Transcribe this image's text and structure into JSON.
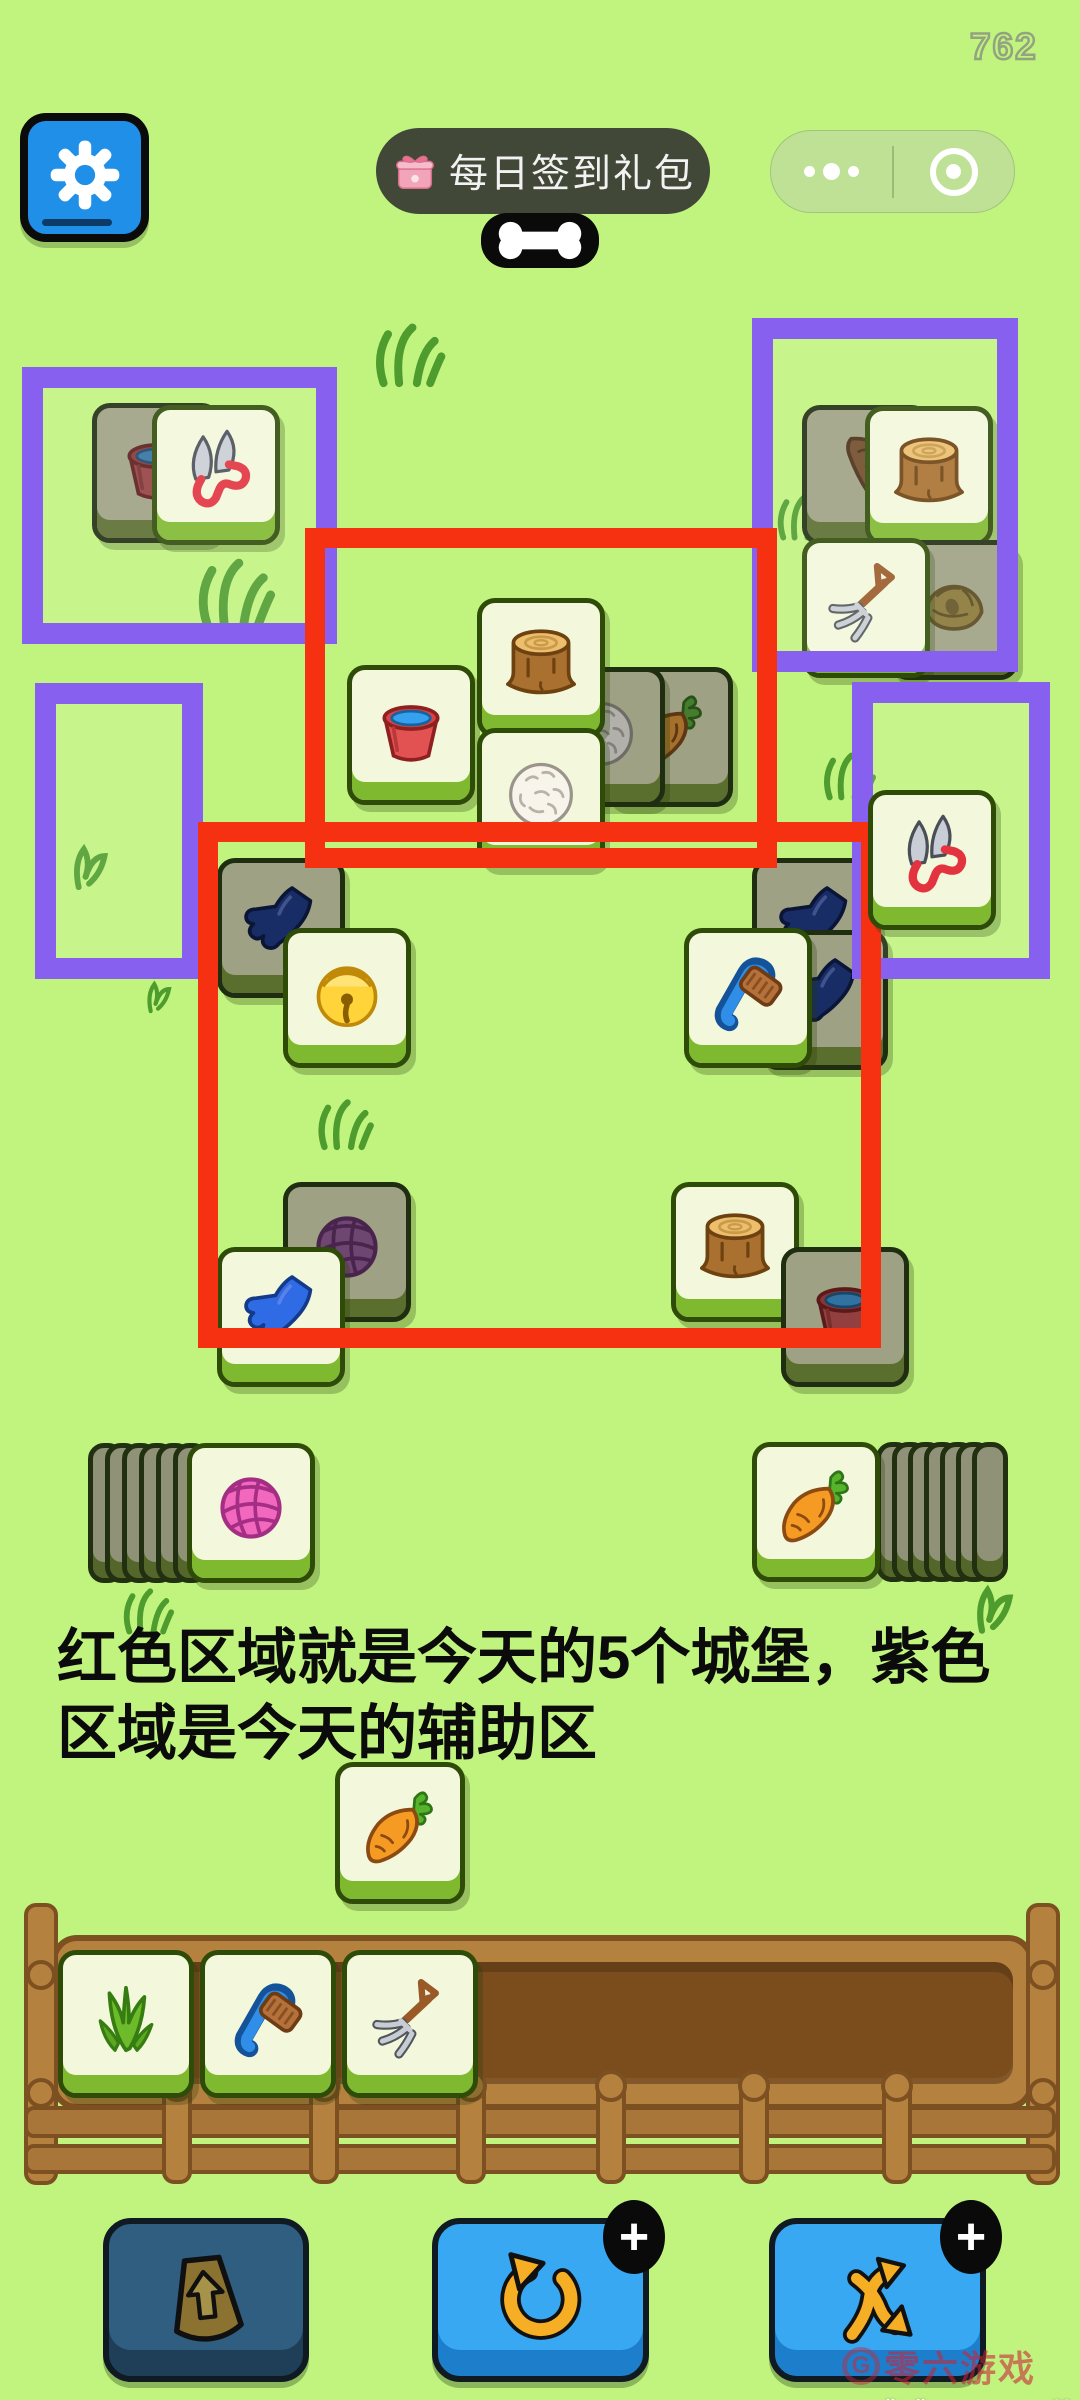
{
  "colors": {
    "background": "#C1F47F",
    "annotation_red": "#F53111",
    "annotation_purple": "#8760EF",
    "tile_front_bg": "#F3F8DC",
    "tile_dark_bg": "#9EA183",
    "button_blue": "#38A8F2"
  },
  "hud": {
    "counter": "762",
    "settings": {
      "icon": "gear-icon"
    },
    "signin_pill": {
      "icon": "gift-icon",
      "label": "每日签到礼包"
    },
    "wechat_capsule": {
      "more_icon": "more-dots-icon",
      "close_icon": "circle-dot-icon"
    },
    "bone": {
      "icon": "bone-icon"
    }
  },
  "annotations": {
    "purple_rects": [
      {
        "x": 22,
        "y": 367,
        "w": 315,
        "h": 277
      },
      {
        "x": 752,
        "y": 318,
        "w": 266,
        "h": 354
      },
      {
        "x": 35,
        "y": 683,
        "w": 168,
        "h": 296
      },
      {
        "x": 852,
        "y": 682,
        "w": 198,
        "h": 297
      }
    ],
    "red_rects": [
      {
        "x": 305,
        "y": 528,
        "w": 472,
        "h": 340
      },
      {
        "x": 198,
        "y": 822,
        "w": 683,
        "h": 526
      }
    ]
  },
  "board": {
    "tiles": [
      {
        "icon": "bucket",
        "x": 92,
        "y": 403,
        "state": "dark"
      },
      {
        "icon": "shears",
        "x": 152,
        "y": 405,
        "state": "front"
      },
      {
        "icon": "bread",
        "x": 802,
        "y": 405,
        "state": "dark"
      },
      {
        "icon": "stump",
        "x": 865,
        "y": 406,
        "state": "front"
      },
      {
        "icon": "hay",
        "x": 890,
        "y": 540,
        "state": "dark"
      },
      {
        "icon": "fork",
        "x": 802,
        "y": 538,
        "state": "front"
      },
      {
        "icon": "carrot",
        "x": 605,
        "y": 667,
        "state": "dark"
      },
      {
        "icon": "wool",
        "x": 537,
        "y": 667,
        "state": "dark"
      },
      {
        "icon": "bucket",
        "x": 347,
        "y": 665,
        "state": "front"
      },
      {
        "icon": "stump",
        "x": 477,
        "y": 598,
        "state": "front"
      },
      {
        "icon": "wool",
        "x": 477,
        "y": 728,
        "state": "front"
      },
      {
        "icon": "glove-navy",
        "x": 217,
        "y": 858,
        "state": "dark"
      },
      {
        "icon": "bell",
        "x": 283,
        "y": 928,
        "state": "front"
      },
      {
        "icon": "glove-navy",
        "x": 752,
        "y": 858,
        "state": "dark"
      },
      {
        "icon": "glove-navy",
        "x": 760,
        "y": 930,
        "state": "dark"
      },
      {
        "icon": "brush",
        "x": 684,
        "y": 928,
        "state": "front"
      },
      {
        "icon": "yarn-purple",
        "x": 283,
        "y": 1182,
        "state": "dark"
      },
      {
        "icon": "glove-blue",
        "x": 217,
        "y": 1247,
        "state": "front"
      },
      {
        "icon": "stump",
        "x": 671,
        "y": 1182,
        "state": "front"
      },
      {
        "icon": "bucket",
        "x": 781,
        "y": 1247,
        "state": "dark"
      },
      {
        "icon": "shears",
        "x": 868,
        "y": 790,
        "state": "front",
        "top": true
      }
    ]
  },
  "stacks": {
    "left": {
      "front_icon": "yarn-pink",
      "x": 187,
      "y": 1443,
      "slivers": 6,
      "sliver_start": 88,
      "sliver_step": 17
    },
    "right": {
      "front_icon": "carrot",
      "x": 752,
      "y": 1442,
      "slivers": 7,
      "sliver_start": 876,
      "sliver_step": 16
    }
  },
  "caption": {
    "line1": "红色区域就是今天的5个城堡，紫色",
    "line2": "区域是今天的辅助区"
  },
  "free_tile": {
    "icon": "carrot",
    "x": 335,
    "y": 1762
  },
  "rack": {
    "tiles": [
      {
        "icon": "grass",
        "x": 58,
        "y": 1950
      },
      {
        "icon": "brush",
        "x": 200,
        "y": 1950
      },
      {
        "icon": "fork",
        "x": 342,
        "y": 1950
      }
    ],
    "posts_x": [
      177,
      324,
      471,
      611,
      754,
      897
    ],
    "rails": [
      {
        "x": 24,
        "y": 2106,
        "w": 1032,
        "h": 32
      },
      {
        "x": 24,
        "y": 2144,
        "w": 1032,
        "h": 30
      }
    ]
  },
  "toolbar": {
    "buttons": [
      {
        "name": "bag-button",
        "icon": "bag-icon",
        "x": 103,
        "w": 206,
        "state": "disabled",
        "badge": ""
      },
      {
        "name": "undo-button",
        "icon": "undo-icon",
        "x": 432,
        "w": 217,
        "state": "active",
        "badge": "+"
      },
      {
        "name": "shuffle-button",
        "icon": "shuffle-icon",
        "x": 769,
        "w": 217,
        "state": "active",
        "badge": "+"
      }
    ]
  },
  "watermark": {
    "roundel": "G",
    "brand": "零六游戏",
    "urls": [
      "www.lingliuyx.com",
      "www.06zyx.com"
    ]
  },
  "decor": [
    {
      "type": "tuft",
      "x": 368,
      "y": 312,
      "s": 80
    },
    {
      "type": "tuft",
      "x": 190,
      "y": 546,
      "s": 88
    },
    {
      "type": "sprout",
      "x": 58,
      "y": 832,
      "s": 62
    },
    {
      "type": "sprout",
      "x": 136,
      "y": 972,
      "s": 44
    },
    {
      "type": "tuft",
      "x": 772,
      "y": 486,
      "s": 58
    },
    {
      "type": "tuft",
      "x": 818,
      "y": 744,
      "s": 60
    },
    {
      "type": "tuft",
      "x": 312,
      "y": 1090,
      "s": 64
    },
    {
      "type": "tuft",
      "x": 118,
      "y": 1580,
      "s": 58
    },
    {
      "type": "sprout",
      "x": 960,
      "y": 1572,
      "s": 66
    }
  ]
}
